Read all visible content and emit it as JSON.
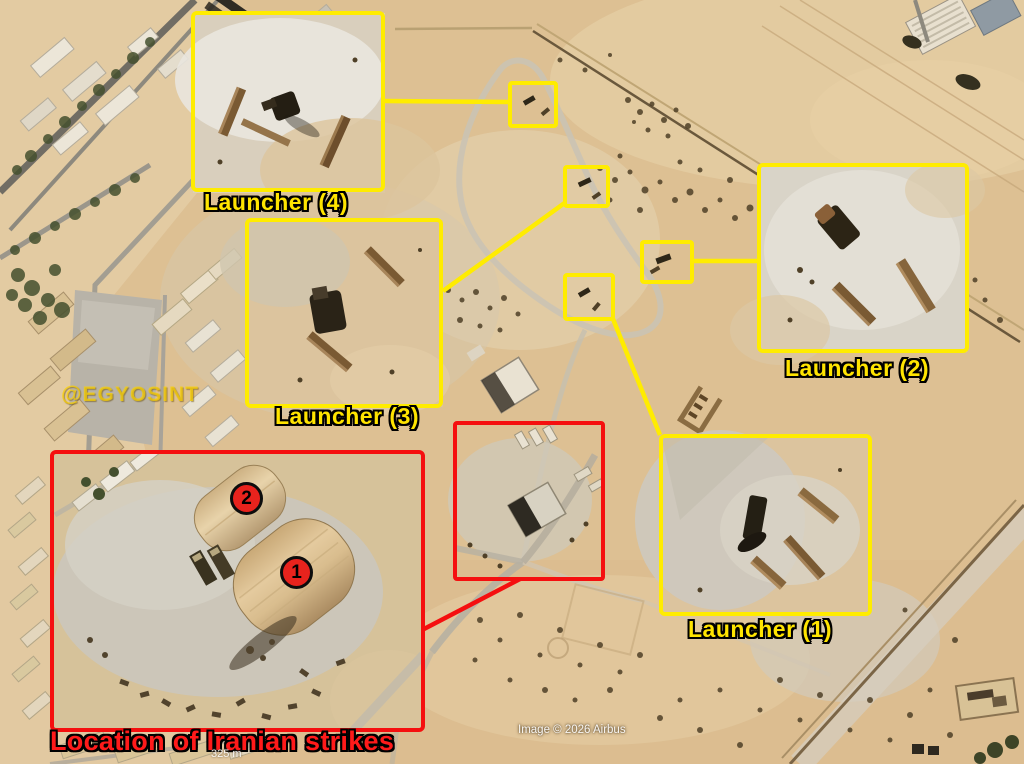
{
  "callouts": {
    "launchers": [
      {
        "id": "launcher-4",
        "label": "Launcher (4)"
      },
      {
        "id": "launcher-3",
        "label": "Launcher (3)"
      },
      {
        "id": "launcher-2",
        "label": "Launcher (2)"
      },
      {
        "id": "launcher-1",
        "label": "Launcher (1)"
      }
    ],
    "strike": {
      "label": "Location of Iranian strikes",
      "markers": [
        "2",
        "1"
      ]
    }
  },
  "watermark": "@EGYOSINT",
  "credit": "Image © 2026 Airbus",
  "scale_label": "325 m",
  "colors": {
    "launcher_callout": "#ffec00",
    "strike_callout": "#f50f0f",
    "label_yellow": "#ffe400",
    "label_red": "#ff1a1a",
    "marker_fill": "#e8231d",
    "sand": "#ddc093"
  }
}
